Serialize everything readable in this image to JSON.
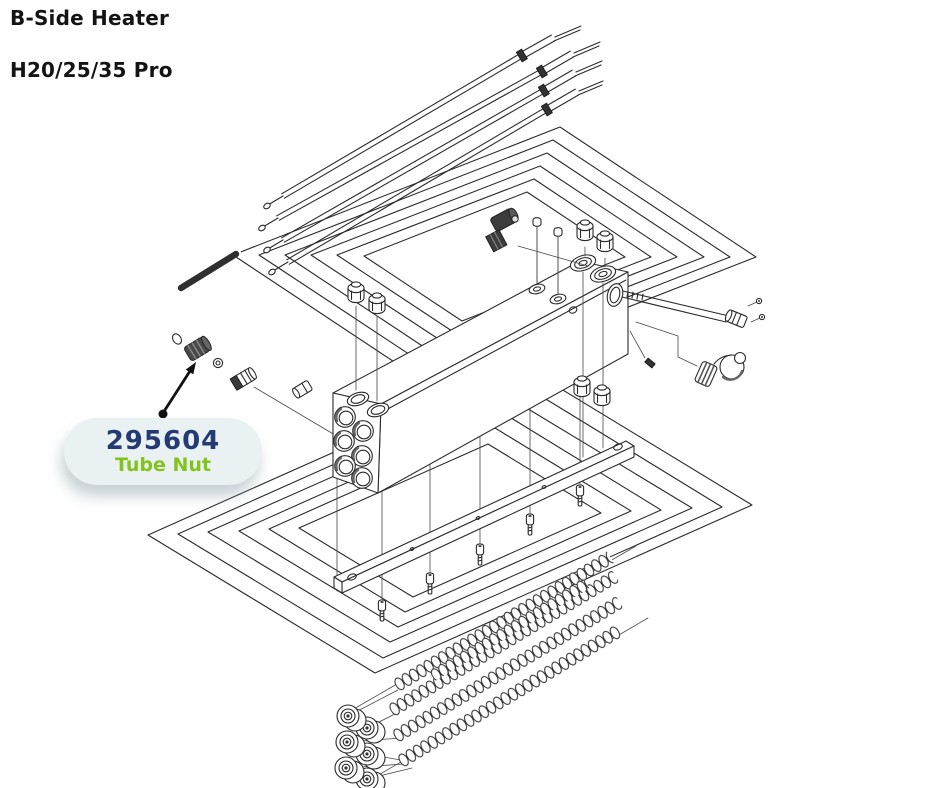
{
  "title": {
    "line1": "B-Side Heater",
    "line2": "H20/25/35 Pro"
  },
  "callout": {
    "part_number": "295604",
    "part_name": "Tube Nut"
  },
  "colors": {
    "background": "#ffffff",
    "title_text": "#141414",
    "line_art": "#2b2b2b",
    "callout_bg": "#e9f1f2",
    "part_number_text": "#253a73",
    "part_name_text": "#82c31c"
  },
  "diagram": {
    "kind": "exploded-parts-diagram",
    "subject": "B-side heater assembly"
  }
}
